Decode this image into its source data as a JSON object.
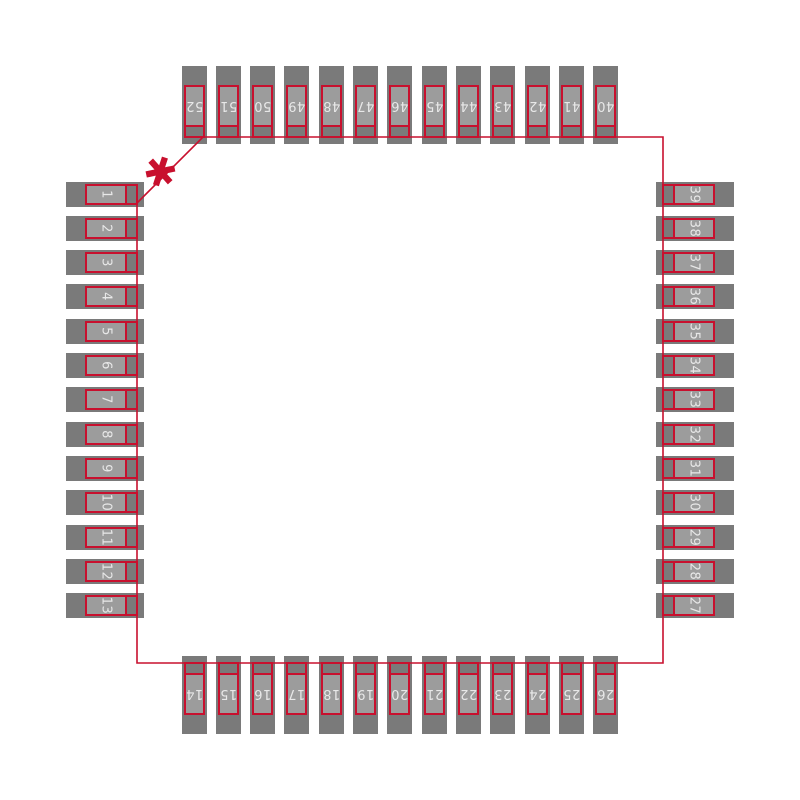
{
  "colors": {
    "outline_red": "#c8102e",
    "pad_gray": "#7a7a7a",
    "lead_gray": "#9c9c9c",
    "pin_text": "#e8e8e8",
    "background": "#ffffff"
  },
  "pin1_marker": {
    "glyph": "✱"
  },
  "package": {
    "pads": {
      "top": [
        "52",
        "51",
        "50",
        "49",
        "48",
        "47",
        "46",
        "45",
        "44",
        "43",
        "42",
        "41",
        "40"
      ],
      "left": [
        "1",
        "2",
        "3",
        "4",
        "5",
        "6",
        "7",
        "8",
        "9",
        "10",
        "11",
        "12",
        "13"
      ],
      "right": [
        "39",
        "38",
        "37",
        "36",
        "35",
        "34",
        "33",
        "32",
        "31",
        "30",
        "29",
        "28",
        "27"
      ],
      "bottom": [
        "14",
        "15",
        "16",
        "17",
        "18",
        "19",
        "20",
        "21",
        "22",
        "23",
        "24",
        "25",
        "26"
      ]
    }
  }
}
